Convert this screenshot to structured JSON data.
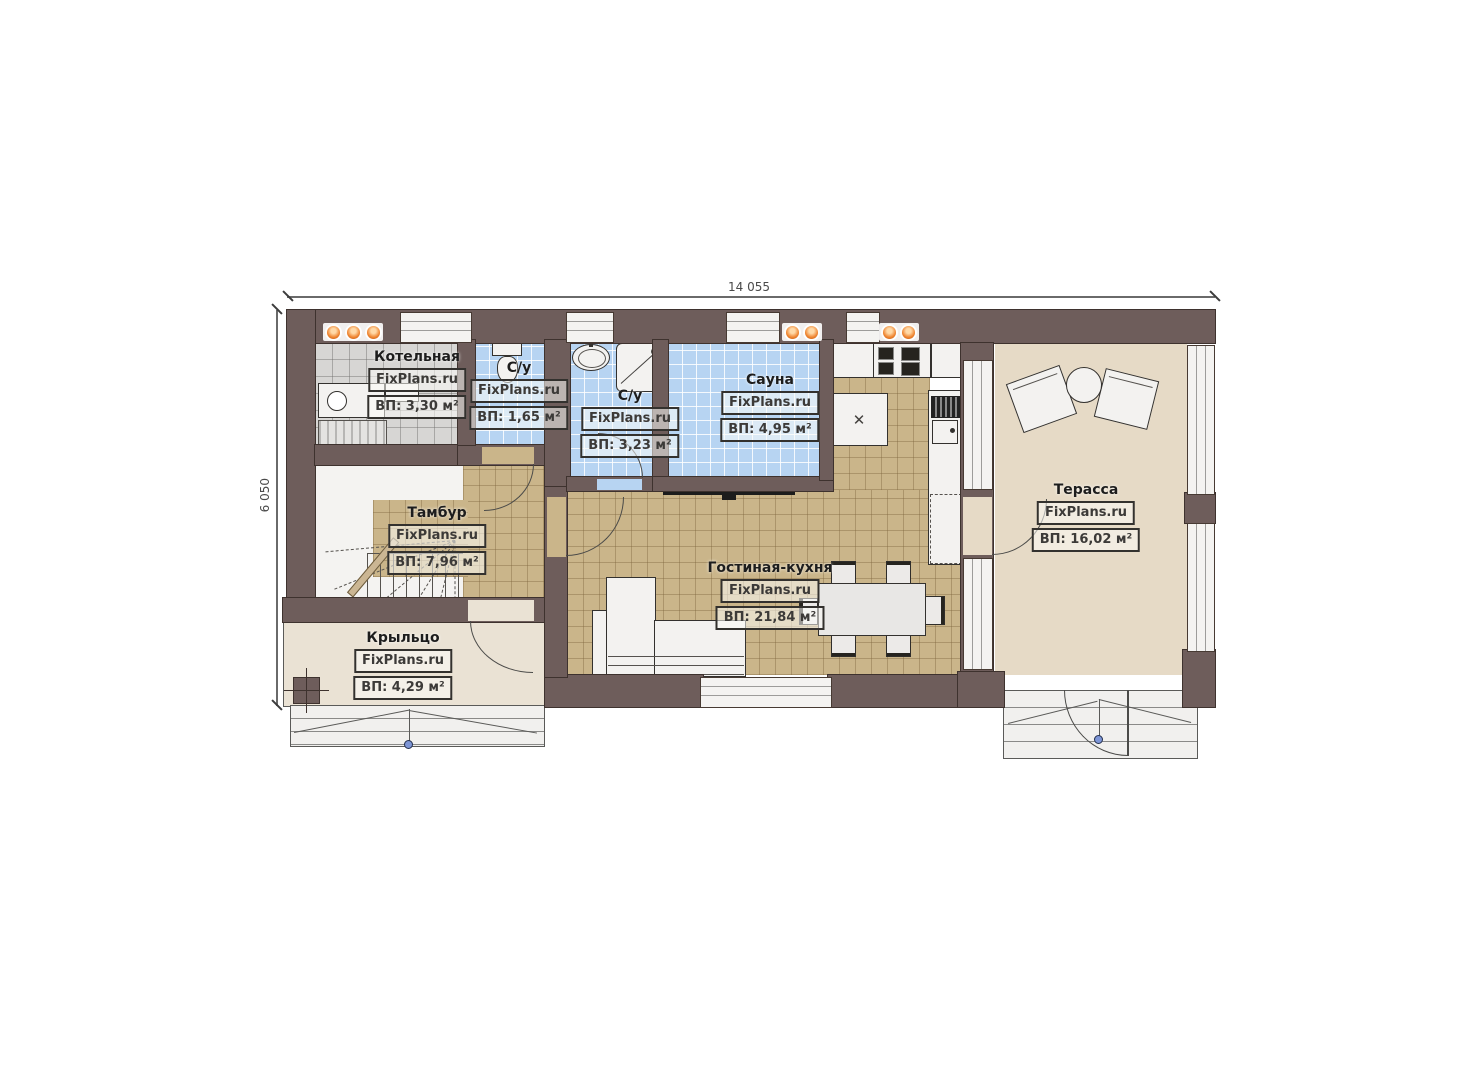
{
  "page": {
    "type": "architectural-floor-plan",
    "background": "#ffffff"
  },
  "brand": "FixPlans.ru",
  "dimensions": {
    "top": "14 055",
    "left": "6 050"
  },
  "rooms": [
    {
      "id": "boiler",
      "name": "Котельная",
      "area": "ВП: 3,30 м²"
    },
    {
      "id": "wc",
      "name": "С/у",
      "area": "ВП: 1,65 м²"
    },
    {
      "id": "shower-room",
      "name": "С/у",
      "area": "ВП: 3,23 м²"
    },
    {
      "id": "sauna",
      "name": "Сауна",
      "area": "ВП: 4,95 м²"
    },
    {
      "id": "vestibule",
      "name": "Тамбур",
      "area": "ВП: 7,96 м²"
    },
    {
      "id": "living-kitchen",
      "name": "Гостиная-кухня",
      "area": "ВП: 21,84 м²"
    },
    {
      "id": "porch",
      "name": "Крыльцо",
      "area": "ВП: 4,29 м²"
    },
    {
      "id": "terrace",
      "name": "Терасса",
      "area": "ВП: 16,02 м²"
    }
  ],
  "colors": {
    "wall": "#6e5d5b",
    "tile_blue": "#b7d4f2",
    "tile_tan": "#cab58a",
    "tile_gray": "#d7d6d4",
    "terrace_floor": "#e6dac6",
    "porch_floor": "#eae2d4",
    "radiator_orange": "#ef8430"
  }
}
